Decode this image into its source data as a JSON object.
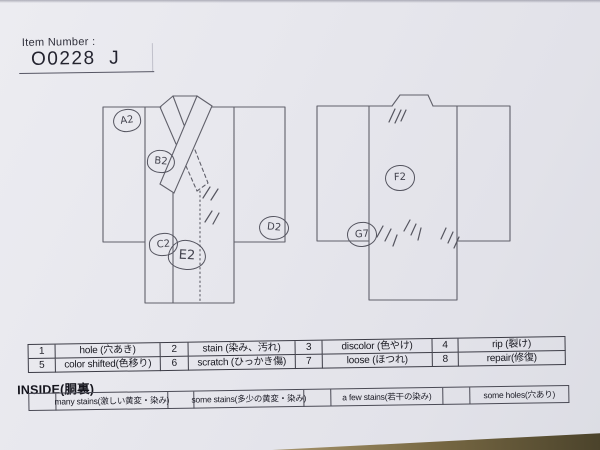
{
  "header": {
    "item_number_label": "Item Number :",
    "item_number_value": "O0228  J"
  },
  "diagram": {
    "annotations": [
      {
        "label": "A2"
      },
      {
        "label": "B2"
      },
      {
        "label": "C2"
      },
      {
        "label": "E2"
      },
      {
        "label": "D2"
      },
      {
        "label": "F2"
      },
      {
        "label": "G7"
      }
    ]
  },
  "legend": {
    "items": [
      {
        "num": "1",
        "label": "hole (穴あき)"
      },
      {
        "num": "2",
        "label": "stain (染み、汚れ)"
      },
      {
        "num": "3",
        "label": "discolor (色やけ)"
      },
      {
        "num": "4",
        "label": "rip (裂け)"
      },
      {
        "num": "5",
        "label": "color shifted(色移り)"
      },
      {
        "num": "6",
        "label": "scratch (ひっかき傷)"
      },
      {
        "num": "7",
        "label": "loose (ほつれ)"
      },
      {
        "num": "8",
        "label": "repair(修復)"
      }
    ]
  },
  "inside": {
    "heading": "INSIDE(胴裏)",
    "options": [
      {
        "label": "many stains(激しい黄変・染み)"
      },
      {
        "label": "some stains(多少の黄変・染み)"
      },
      {
        "label": "a few stains(若干の染み)"
      },
      {
        "label": "some holes(穴あり)"
      }
    ]
  },
  "colors": {
    "paper": "#e7e7ed",
    "printed_ink": "#1c1c26",
    "hand_ink": "#4a4a55",
    "desk_surface": "#5a4f33"
  }
}
